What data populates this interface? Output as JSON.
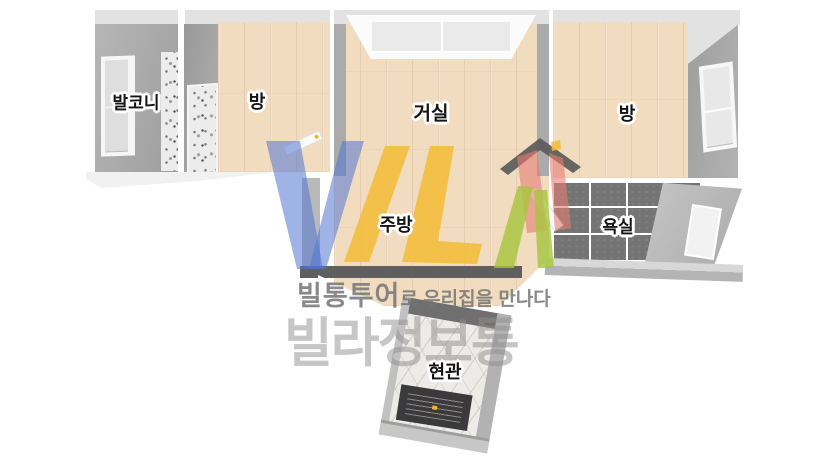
{
  "rooms": {
    "balcony": {
      "label": "발코니"
    },
    "room_left": {
      "label": "방"
    },
    "living": {
      "label": "거실"
    },
    "room_right": {
      "label": "방"
    },
    "kitchen": {
      "label": "주방"
    },
    "bath": {
      "label": "욕실"
    },
    "entrance": {
      "label": "현관"
    }
  },
  "watermark": {
    "logo_text": "VILA",
    "logo_icon": "house-logo-icon",
    "tagline_bold": "빌통투어",
    "tagline_rest": "로 우리집을 만나다",
    "brand": "빌라정보통"
  },
  "palette": {
    "wood": "#f1dcbf",
    "wall": "#a8a8a8",
    "ceiling": "#e2e2e2",
    "terrazzo-bg": "#ececec",
    "tile": "#747474",
    "grout": "#ffffff",
    "bar": "#5f5f5f",
    "marble": "#edebe7",
    "mat": "#3a3a3c",
    "shadow": "#f1f1f1",
    "logo-blue": "#5274d4",
    "logo-yellow": "#f3bc34",
    "logo-green": "#a6c63c",
    "logo-red": "#e67d73",
    "logo-roof": "#5a5a5a",
    "text-label": "#141414",
    "brand-gray": "#8f8f8f",
    "tagline-gray": "#757575"
  }
}
